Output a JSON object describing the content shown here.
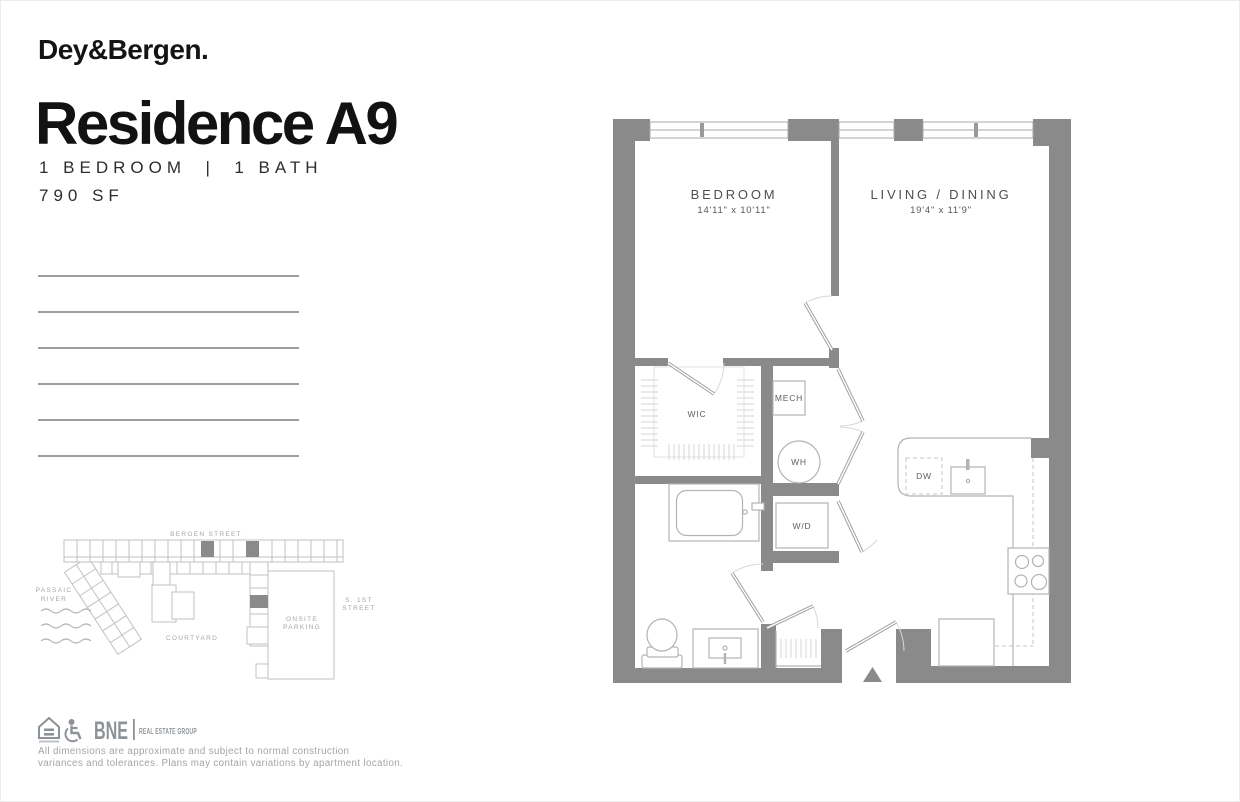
{
  "brand": "Dey&Bergen.",
  "header": {
    "title": "Residence A9",
    "subtitle": "1 BEDROOM  |  1 BATH",
    "area": "790 SF"
  },
  "floorplan": {
    "bedroom": {
      "name": "BEDROOM",
      "dims": "14'11\" x 10'11\""
    },
    "living": {
      "name": "LIVING / DINING",
      "dims": "19'4\" x 11'9\""
    },
    "wic": "WIC",
    "mech": "MECH",
    "wh": "WH",
    "wd": "W/D",
    "dw": "DW"
  },
  "siteplan": {
    "bergen": "BERGEN STREET",
    "passaic1": "PASSAIC",
    "passaic2": "RIVER",
    "courtyard": "COURTYARD",
    "onsite1": "ONSITE",
    "onsite2": "PARKING",
    "s1st1": "S. 1ST",
    "s1st2": "STREET"
  },
  "footer": {
    "bne": "BNE",
    "group": "REAL ESTATE GROUP",
    "disclaimer1": "All dimensions are approximate and subject to normal construction",
    "disclaimer2": "variances and tolerances. Plans may contain variations by apartment location."
  },
  "colors": {
    "wall_gray": "#8a8a8a",
    "fixture_gray": "#b3b3b3",
    "site_line_gray": "#c2c2c2",
    "label_gray": "#4e4e4e",
    "brand_gray": "#8d9296",
    "text_black": "#121212"
  }
}
